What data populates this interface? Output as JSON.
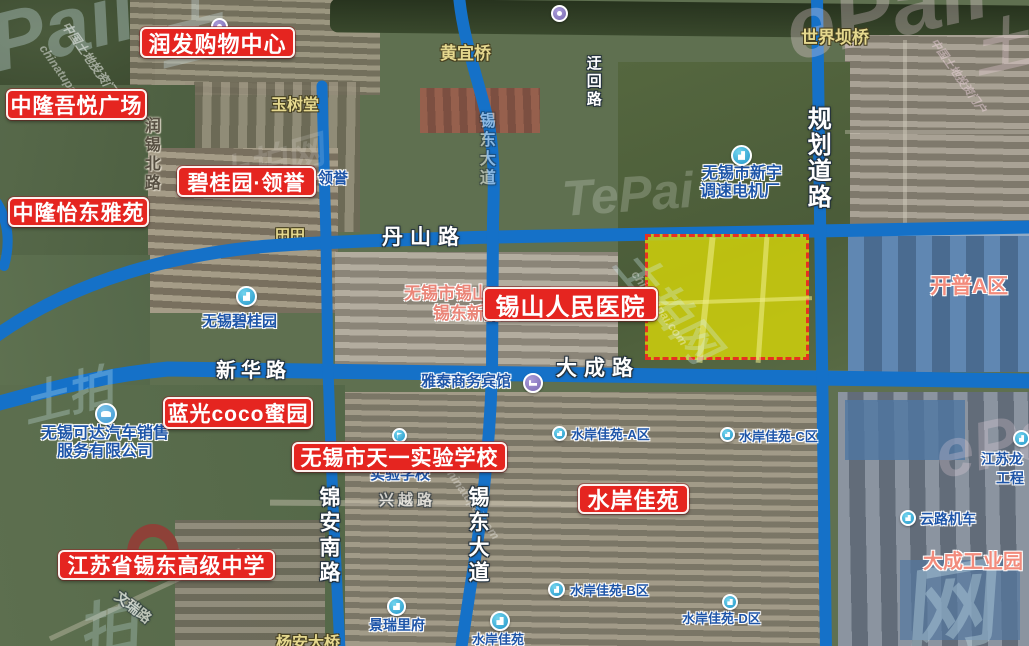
{
  "map_title": "无锡锡山区地块卫星图 (satellite parcel map)",
  "colors": {
    "road_blue": "#1571c8",
    "parcel_fill": "#d6d508",
    "parcel_border": "#e63122",
    "red_label_bg": "#e52520",
    "poi_text_blue": "#1e55a8",
    "area_text_salmon": "#f28b7c",
    "bridge_text_yellow": "#e5d88e"
  },
  "parcel": {
    "x": 645,
    "y": 234,
    "w": 164,
    "h": 126,
    "note": "highlighted land parcel, yellow with red dashed border"
  },
  "red_labels": [
    {
      "text": "润发购物中心",
      "x": 140,
      "y": 27,
      "w": 155,
      "h": 31,
      "fs": 22
    },
    {
      "text": "中隆吾悦广场",
      "x": 6,
      "y": 89,
      "w": 141,
      "h": 31,
      "fs": 21
    },
    {
      "text": "碧桂园·领誉",
      "x": 177,
      "y": 166,
      "w": 139,
      "h": 31,
      "fs": 21
    },
    {
      "text": "中隆怡东雅苑",
      "x": 8,
      "y": 197,
      "w": 141,
      "h": 30,
      "fs": 21
    },
    {
      "text": "锡山人民医院",
      "x": 483,
      "y": 287,
      "w": 175,
      "h": 34,
      "fs": 24
    },
    {
      "text": "蓝光coco蜜园",
      "x": 163,
      "y": 397,
      "w": 150,
      "h": 32,
      "fs": 21
    },
    {
      "text": "无锡市天一实验学校",
      "x": 292,
      "y": 442,
      "w": 215,
      "h": 30,
      "fs": 21
    },
    {
      "text": "水岸佳苑",
      "x": 578,
      "y": 484,
      "w": 111,
      "h": 30,
      "fs": 22
    },
    {
      "text": "江苏省锡东高级中学",
      "x": 58,
      "y": 550,
      "w": 217,
      "h": 30,
      "fs": 21
    }
  ],
  "road_labels_h": [
    {
      "text": "丹山路",
      "x": 382,
      "y": 227,
      "fs": 21,
      "ls": 7
    },
    {
      "text": "新华路",
      "x": 216,
      "y": 361,
      "fs": 20,
      "ls": 5
    },
    {
      "text": "大成路",
      "x": 556,
      "y": 358,
      "fs": 21,
      "ls": 7
    }
  ],
  "road_labels_v": [
    {
      "text": "规划道路",
      "x": 804,
      "y": 106,
      "fs": 24,
      "ls": 2
    },
    {
      "text": "锦安南路",
      "x": 317,
      "y": 486,
      "fs": 21,
      "ls": 4
    },
    {
      "text": "锡东大道",
      "x": 466,
      "y": 486,
      "fs": 21,
      "ls": 4
    },
    {
      "text": "迂回路",
      "x": 585,
      "y": 55,
      "fs": 15,
      "ls": 3
    },
    {
      "text": "锡东大道",
      "x": 476,
      "y": 112,
      "fs": 16,
      "ls": 3,
      "op": 0.5
    },
    {
      "text": "润锡北路",
      "x": 141,
      "y": 117,
      "fs": 16,
      "ls": 3,
      "cls": "dark"
    }
  ],
  "poi_texts": [
    {
      "text": "无锡市新宇",
      "x": 702,
      "y": 166,
      "fs": 16
    },
    {
      "text": "调速电机厂",
      "x": 700,
      "y": 184,
      "fs": 16
    },
    {
      "text": "无锡碧桂园",
      "x": 202,
      "y": 314,
      "fs": 15
    },
    {
      "text": "无锡可达汽车销售",
      "x": 41,
      "y": 426,
      "fs": 16
    },
    {
      "text": "服务有限公司",
      "x": 57,
      "y": 444,
      "fs": 16
    },
    {
      "text": "雅泰商务宾馆",
      "x": 421,
      "y": 374,
      "fs": 15
    },
    {
      "text": "水岸佳苑-A区",
      "x": 571,
      "y": 428,
      "fs": 13
    },
    {
      "text": "水岸佳苑-C区",
      "x": 739,
      "y": 430,
      "fs": 13
    },
    {
      "text": "水岸佳苑-B区",
      "x": 570,
      "y": 584,
      "fs": 13
    },
    {
      "text": "水岸佳苑-D区",
      "x": 682,
      "y": 612,
      "fs": 13
    },
    {
      "text": "水岸佳苑",
      "x": 472,
      "y": 633,
      "fs": 13
    },
    {
      "text": "景瑞里府",
      "x": 369,
      "y": 618,
      "fs": 14
    },
    {
      "text": "云路机车",
      "x": 920,
      "y": 512,
      "fs": 14
    },
    {
      "text": "江苏龙",
      "x": 981,
      "y": 452,
      "fs": 14
    },
    {
      "text": "工程",
      "x": 996,
      "y": 471,
      "fs": 14
    },
    {
      "text": "实验学校",
      "x": 370,
      "y": 467,
      "fs": 15
    },
    {
      "text": "园·领誉",
      "x": 298,
      "y": 171,
      "fs": 15
    }
  ],
  "pink_texts": [
    {
      "text": "无锡市锡山",
      "x": 404,
      "y": 285,
      "fs": 17
    },
    {
      "text": "锡东新院区",
      "x": 433,
      "y": 305,
      "fs": 17
    }
  ],
  "yellow_texts": [
    {
      "text": "黄宜桥",
      "x": 440,
      "y": 45,
      "fs": 17
    },
    {
      "text": "世界坝桥",
      "x": 801,
      "y": 29,
      "fs": 17
    },
    {
      "text": "玉树堂",
      "x": 271,
      "y": 98,
      "fs": 16
    },
    {
      "text": "杨安大桥",
      "x": 276,
      "y": 636,
      "fs": 16
    },
    {
      "text": "田田",
      "x": 275,
      "y": 228,
      "fs": 15,
      "cls": "under"
    }
  ],
  "salmon_texts": [
    {
      "text": "开普A区",
      "x": 930,
      "y": 276,
      "fs": 21
    },
    {
      "text": "大成工业园",
      "x": 923,
      "y": 552,
      "fs": 20
    }
  ],
  "faint_texts": [
    {
      "text": "兴越路",
      "x": 379,
      "y": 493,
      "fs": 15,
      "op": 0.65,
      "ls": 4
    },
    {
      "text": "文瑞路",
      "x": 112,
      "y": 600,
      "fs": 14,
      "op": 0.6,
      "rot": 38
    }
  ],
  "poi_icons": [
    {
      "type": "building",
      "x": 731,
      "y": 145,
      "d": 21
    },
    {
      "type": "building",
      "x": 236,
      "y": 286,
      "d": 21
    },
    {
      "type": "building",
      "x": 552,
      "y": 426,
      "d": 15
    },
    {
      "type": "building",
      "x": 720,
      "y": 427,
      "d": 15
    },
    {
      "type": "building",
      "x": 548,
      "y": 581,
      "d": 17
    },
    {
      "type": "building",
      "x": 722,
      "y": 594,
      "d": 16
    },
    {
      "type": "building",
      "x": 490,
      "y": 611,
      "d": 20
    },
    {
      "type": "building",
      "x": 387,
      "y": 597,
      "d": 19
    },
    {
      "type": "building",
      "x": 900,
      "y": 510,
      "d": 16
    },
    {
      "type": "building",
      "x": 1013,
      "y": 430,
      "d": 17
    },
    {
      "type": "flag",
      "x": 392,
      "y": 428,
      "d": 15
    },
    {
      "type": "car",
      "x": 95,
      "y": 403,
      "d": 22
    },
    {
      "type": "bed",
      "x": 523,
      "y": 373,
      "d": 20
    },
    {
      "type": "purple",
      "x": 211,
      "y": 18,
      "d": 17
    },
    {
      "type": "purple",
      "x": 551,
      "y": 5,
      "d": 17
    }
  ],
  "watermarks": [
    {
      "text": "Pail",
      "x": -20,
      "y": 0,
      "fs": 82,
      "rot": -14,
      "color": "#d9f1f7",
      "op": 0.32
    },
    {
      "text": "土",
      "x": 142,
      "y": -12,
      "fs": 70,
      "rot": -14,
      "color": "#d9f1f7",
      "op": 0.3
    },
    {
      "text": "中国土地投资门户",
      "x": 72,
      "y": 18,
      "fs": 12,
      "rot": 55,
      "color": "#ffffff",
      "op": 0.5
    },
    {
      "text": "chinatupai.com",
      "x": 48,
      "y": 42,
      "fs": 12,
      "rot": 55,
      "color": "#ffffff",
      "op": 0.45
    },
    {
      "text": "ePail",
      "x": 775,
      "y": -18,
      "fs": 88,
      "rot": -13,
      "color": "#f7dbe7",
      "op": 0.3
    },
    {
      "text": "土",
      "x": 962,
      "y": 8,
      "fs": 58,
      "rot": -13,
      "color": "#f7dbe7",
      "op": 0.3
    },
    {
      "text": "中国土地投资门户",
      "x": 940,
      "y": 35,
      "fs": 11,
      "rot": 55,
      "color": "#f8dce8",
      "op": 0.45
    },
    {
      "text": "TePai",
      "x": 560,
      "y": 170,
      "fs": 50,
      "rot": -4,
      "color": "#ffffff",
      "op": 0.2
    },
    {
      "text": "土拍网",
      "x": 652,
      "y": 232,
      "fs": 44,
      "rot": 50,
      "color": "#d4f1f8",
      "op": 0.3
    },
    {
      "text": "chinatupai.com",
      "x": 640,
      "y": 268,
      "fs": 12,
      "rot": 55,
      "color": "#ffffff",
      "op": 0.38
    },
    {
      "text": "土拍",
      "x": 14,
      "y": 372,
      "fs": 46,
      "rot": -14,
      "color": "#d4f1f8",
      "op": 0.28
    },
    {
      "text": "ePai",
      "x": 928,
      "y": 418,
      "fs": 68,
      "rot": -12,
      "color": "#f7dbe7",
      "op": 0.25
    },
    {
      "text": "网",
      "x": 886,
      "y": 542,
      "fs": 95,
      "rot": -10,
      "color": "#d4f1f8",
      "op": 0.32
    },
    {
      "text": "拍",
      "x": 68,
      "y": 588,
      "fs": 60,
      "rot": -12,
      "color": "#d4f1f8",
      "op": 0.25
    },
    {
      "text": "chinatupai.com",
      "x": 452,
      "y": 462,
      "fs": 12,
      "rot": 55,
      "color": "#ffffff",
      "op": 0.32
    },
    {
      "text": "土拍网",
      "x": 205,
      "y": 150,
      "fs": 38,
      "rot": -16,
      "color": "#ffffff",
      "op": 0.14
    }
  ]
}
